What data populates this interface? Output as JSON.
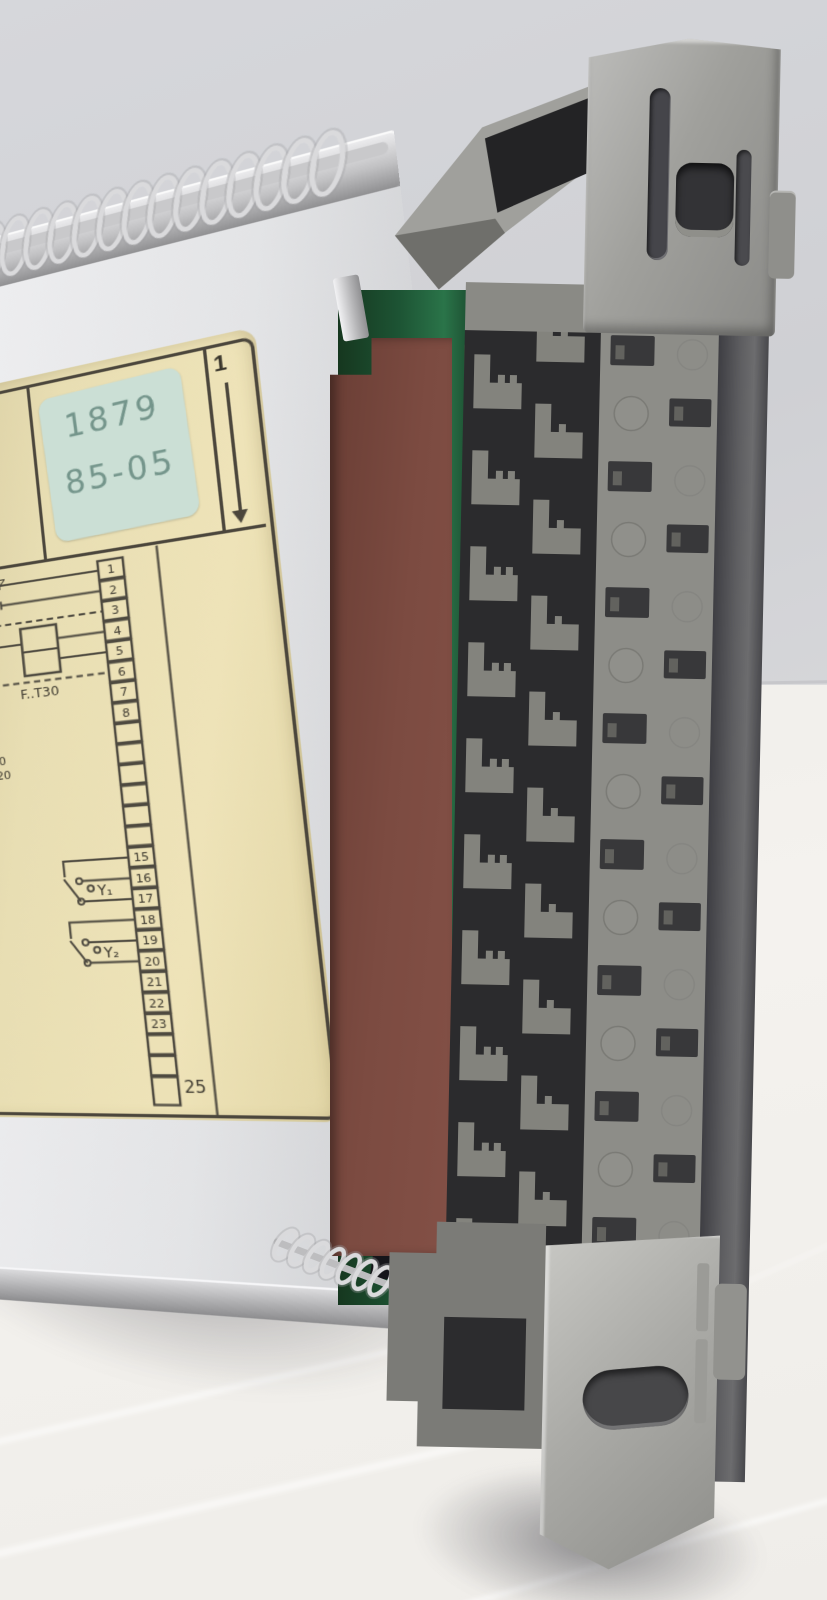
{
  "scene": {
    "wall_color": "#d2d3d7",
    "table_color": "#f2f0ec"
  },
  "module": {
    "label": {
      "type_code_partial": "..22",
      "temperature_range": "0..50°C",
      "sticker": {
        "line1": "1879",
        "line2": "85-05"
      },
      "orientation_number": "1"
    },
    "diagram": {
      "supply_label": "24V~ 50...60Hz",
      "fuse_label": "F..T30",
      "sensor_label": "PU...",
      "device_refs": [
        "F..-H90",
        "FD-H20",
        "DF-..."
      ],
      "switch_upper_label": "5",
      "switch_lower_label": "4",
      "output_1_label": "Y₁",
      "output_2_label": "Y₂",
      "terminals_top": [
        "1",
        "2",
        "3",
        "4",
        "5",
        "6",
        "7",
        "8"
      ],
      "terminals_mid": [
        "15",
        "16",
        "17",
        "18",
        "19",
        "20",
        "21",
        "22",
        "23"
      ],
      "terminal_bottom_label": "25"
    }
  }
}
